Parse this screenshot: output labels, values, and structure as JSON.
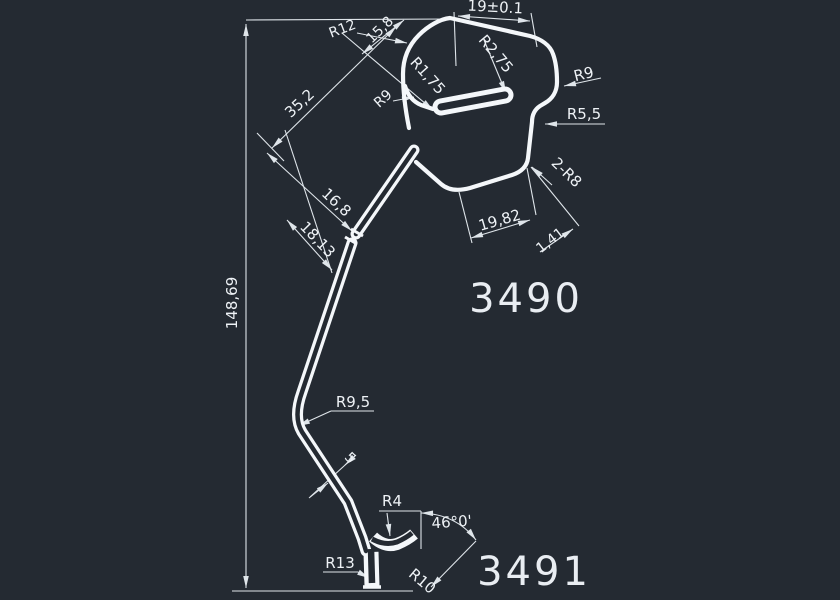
{
  "title": "CAD wire-form part drawing",
  "colors": {
    "background": "#242a32",
    "line": "#f4f7fa",
    "dimension": "#dfe5ea"
  },
  "part_numbers": {
    "upper": "3490",
    "lower": "3491"
  },
  "labels": {
    "r12": "R12",
    "len_top": "15,8",
    "width_tol": "19±0.1",
    "r275": "R2,75",
    "r175": "R1,75",
    "r9_left": "R9",
    "r9_right": "R9",
    "r55": "R5,5",
    "two_r8": "2-R8",
    "d352": "35,2",
    "d168": "16,8",
    "d1813": "18,13",
    "d1982": "19,82",
    "d141": "1,41",
    "height": "148,69",
    "r95": "R9,5",
    "wire_dia": "5",
    "r4": "R4",
    "angle": "46°0'",
    "r13": "R13",
    "r10": "R10"
  }
}
